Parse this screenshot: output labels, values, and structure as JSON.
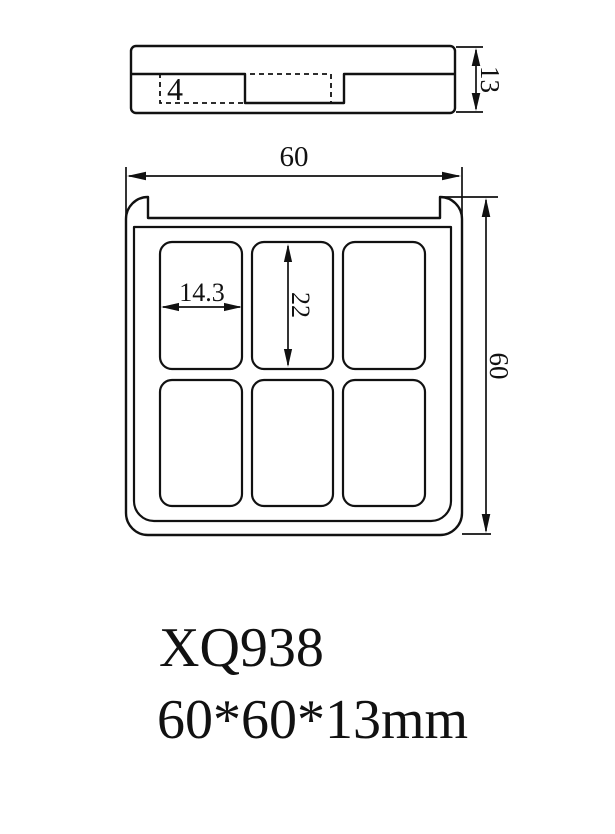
{
  "drawing": {
    "side_view": {
      "depth_label": "4",
      "height_label": "13"
    },
    "front_view": {
      "width_label": "60",
      "height_label": "60",
      "pan_width_label": "14.3",
      "pan_height_label": "22"
    },
    "caption": {
      "model_code": "XQ938",
      "overall_size": "60*60*13mm"
    },
    "colors": {
      "line": "#111111",
      "background": "#ffffff"
    }
  }
}
